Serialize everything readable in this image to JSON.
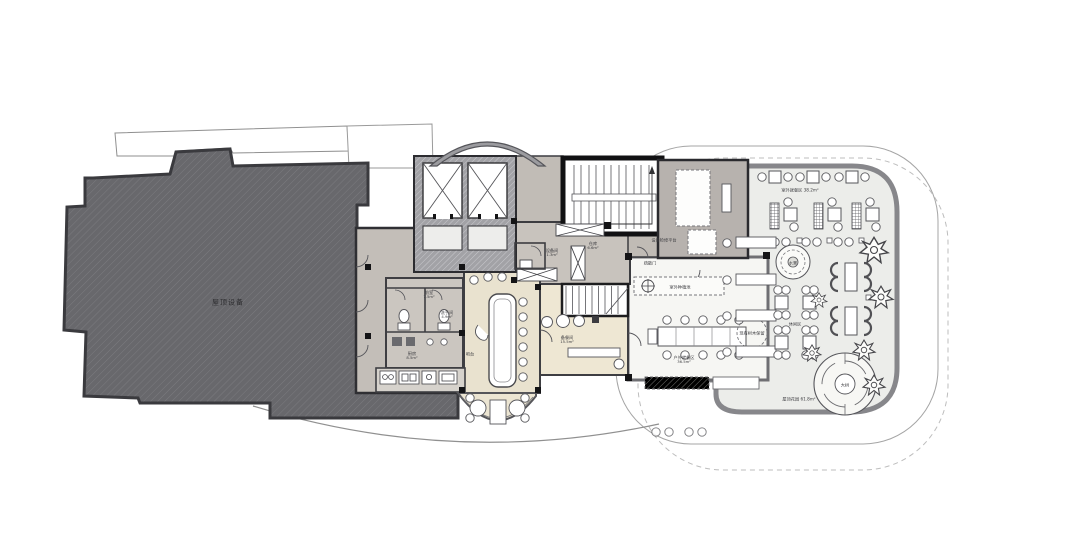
{
  "drawing": {
    "type": "architectural-floor-plan",
    "colors": {
      "roof_hatch": "#68686c",
      "core_floor": "#c3beb8",
      "bar_floor": "#e9e2cf",
      "pantry_floor": "#eee7d3",
      "terrace_floor": "#ecedea",
      "wall_dark": "#2e2e32",
      "terrace_wall": "#87878b"
    },
    "labels": {
      "roof": {
        "name": "屋顶设备",
        "area": ""
      },
      "front": {
        "name": "前室",
        "area": "7.5m²"
      },
      "wash": {
        "name": "洗手间",
        "area": "4.9m²"
      },
      "kitchen": {
        "name": "厨房",
        "area": "8.5m²"
      },
      "bar": {
        "name": "吧台",
        "area": ""
      },
      "pantry": {
        "name": "备餐间",
        "area": "15.5m²"
      },
      "storage": {
        "name": "仓库",
        "area": "6.6m²"
      },
      "equip": {
        "name": "设备间",
        "area": "1.3m²"
      },
      "service": {
        "name": "设备检修平台",
        "area": ""
      },
      "planter": {
        "name": "室外种植池",
        "area": ""
      },
      "exitdoor": {
        "name": "疏散门",
        "area": ""
      },
      "outdoor_top": {
        "name": "室外就餐区 38.2m²",
        "area": ""
      },
      "indoor": {
        "name": "户外就餐区",
        "area": "36.5m²"
      },
      "treekeep": {
        "name": "现有树木保留",
        "area": ""
      },
      "leisure": {
        "name": "休闲区",
        "area": ""
      },
      "water": {
        "name": "水景",
        "area": ""
      },
      "bigtree": {
        "name": "大树",
        "area": ""
      },
      "garden": {
        "name": "屋顶花园 61.8m²",
        "area": ""
      }
    }
  }
}
